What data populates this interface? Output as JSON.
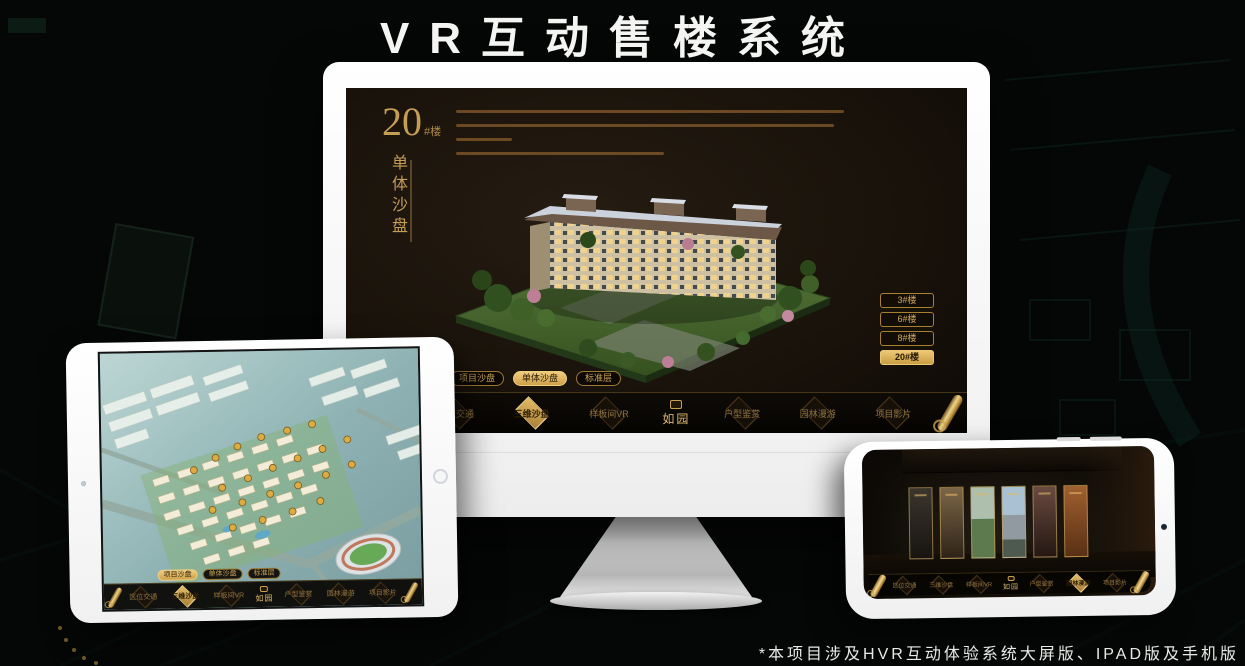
{
  "page": {
    "title": "VR互动售楼系统",
    "footnote": "*本项目涉及HVR互动体验系统大屏版、IPAD版及手机版"
  },
  "colors": {
    "gold": "#cda258",
    "gold_bright": "#eec978",
    "nav_text_gold": "#8f7342",
    "screen_dark": "#17120b",
    "device_white": "#f5f5f5"
  },
  "monitor": {
    "unit_panel": {
      "number": "20",
      "suffix": "#楼",
      "subtitle_vertical": "单体沙盘"
    },
    "floor_buttons": [
      {
        "label": "3#楼",
        "active": false
      },
      {
        "label": "6#楼",
        "active": false
      },
      {
        "label": "8#楼",
        "active": false
      },
      {
        "label": "20#楼",
        "active": true
      }
    ],
    "sub_tabs": [
      {
        "label": "项目沙盘",
        "active": false
      },
      {
        "label": "单体沙盘",
        "active": true
      },
      {
        "label": "标准层",
        "active": false
      }
    ],
    "nav": {
      "items_left": [
        {
          "label": "区位交通",
          "active": false
        },
        {
          "label": "三维沙盘",
          "active": true
        },
        {
          "label": "样板间VR",
          "active": false
        }
      ],
      "logo": "如园",
      "items_right": [
        {
          "label": "户型鉴赏",
          "active": false
        },
        {
          "label": "园林漫游",
          "active": false
        },
        {
          "label": "项目影片",
          "active": false
        }
      ]
    }
  },
  "tablet": {
    "sub_tabs": [
      {
        "label": "项目沙盘",
        "active": true
      },
      {
        "label": "单体沙盘",
        "active": false
      },
      {
        "label": "标准层",
        "active": false
      }
    ],
    "nav": {
      "items_left": [
        {
          "label": "区位交通",
          "active": false
        },
        {
          "label": "三维沙盘",
          "active": true
        },
        {
          "label": "样板间VR",
          "active": false
        }
      ],
      "logo": "如园",
      "items_right": [
        {
          "label": "户型鉴赏",
          "active": false
        },
        {
          "label": "园林漫游",
          "active": false
        },
        {
          "label": "项目影片",
          "active": false
        }
      ]
    }
  },
  "phone": {
    "nav": {
      "items_left": [
        {
          "label": "区位交通",
          "active": false
        },
        {
          "label": "三维沙盘",
          "active": false
        },
        {
          "label": "样板间VR",
          "active": false
        }
      ],
      "logo": "如园",
      "items_right": [
        {
          "label": "户型鉴赏",
          "active": false
        },
        {
          "label": "园林漫游",
          "active": true
        },
        {
          "label": "项目影片",
          "active": false
        }
      ]
    }
  }
}
